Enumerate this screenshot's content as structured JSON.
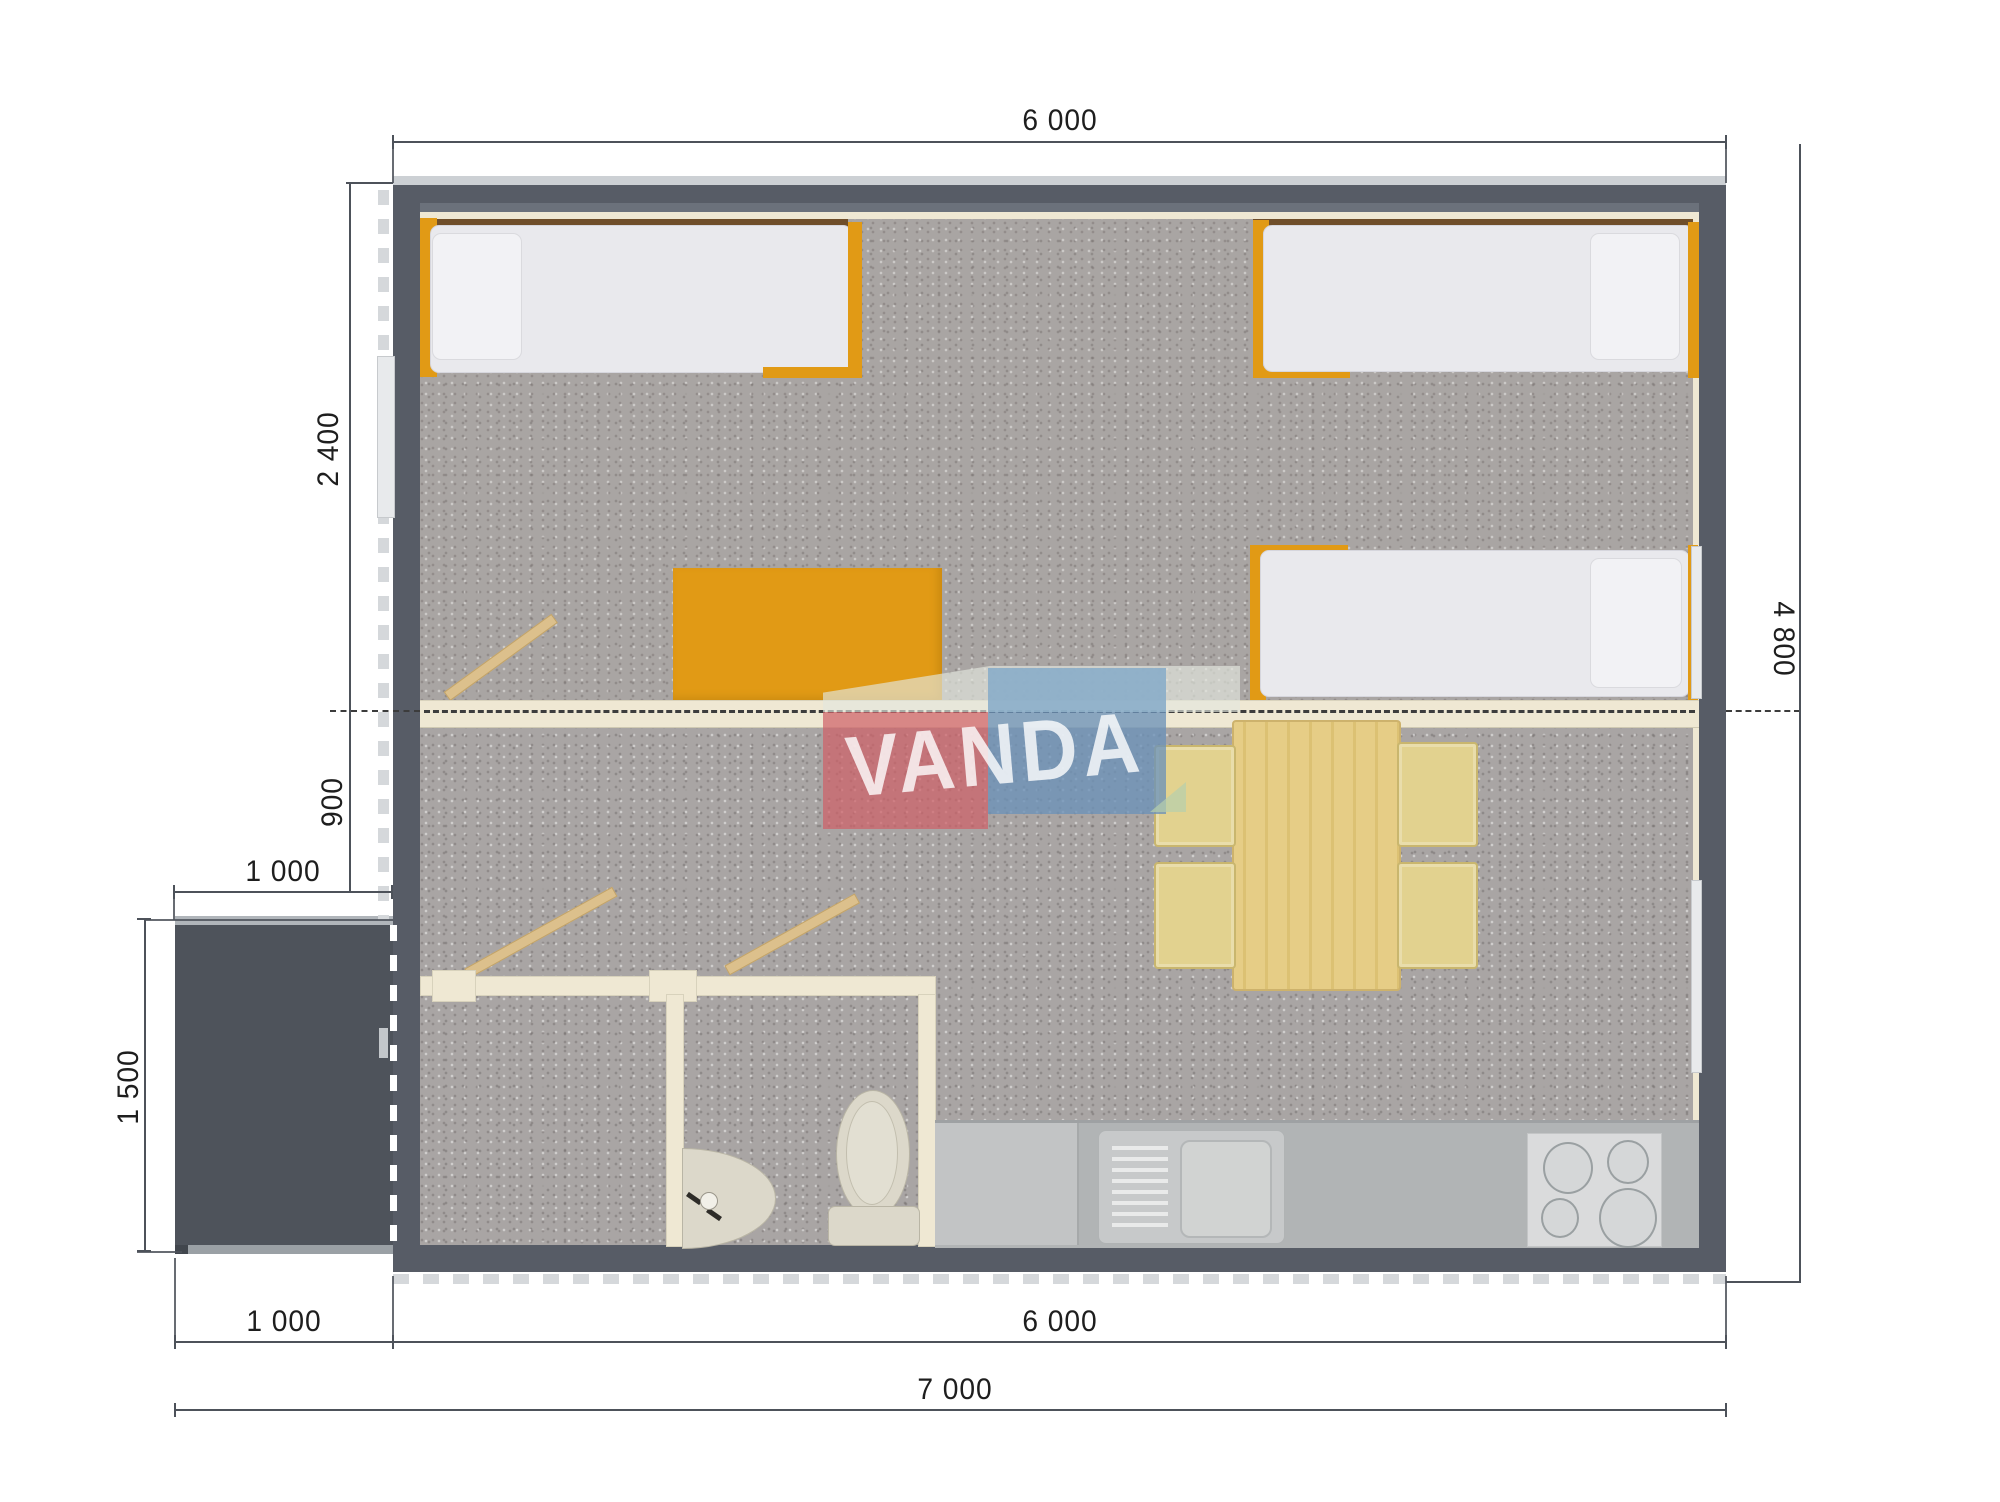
{
  "watermark": {
    "text": "VANDA"
  },
  "dimensions": {
    "top_width": "6 000",
    "bedroom_depth": "2 400",
    "hall_depth": "900",
    "porch_width_top": "1 000",
    "porch_depth": "1 500",
    "right_height": "4 800",
    "bottom_porch": "1 000",
    "bottom_building": "6 000",
    "bottom_total": "7 000"
  },
  "colors": {
    "wall": "#575C66",
    "porch": "#4E535B",
    "carpet": "#A9A5A4",
    "cream": "#EFE8D3",
    "accent_orange": "#E19A15",
    "plank": "#DCC08C",
    "wood_table": "#E5CC85",
    "chair": "#E2D28F",
    "mattress": "#E9E9ED",
    "counter": "#B1B4B5",
    "stove": "#DADBDC",
    "fixture": "#DCD8CA",
    "brown_shelf": "#6F4E2A",
    "dimline": "#4D525A",
    "watermark_red": "#CD6268",
    "watermark_blue": "#6E93B7"
  }
}
